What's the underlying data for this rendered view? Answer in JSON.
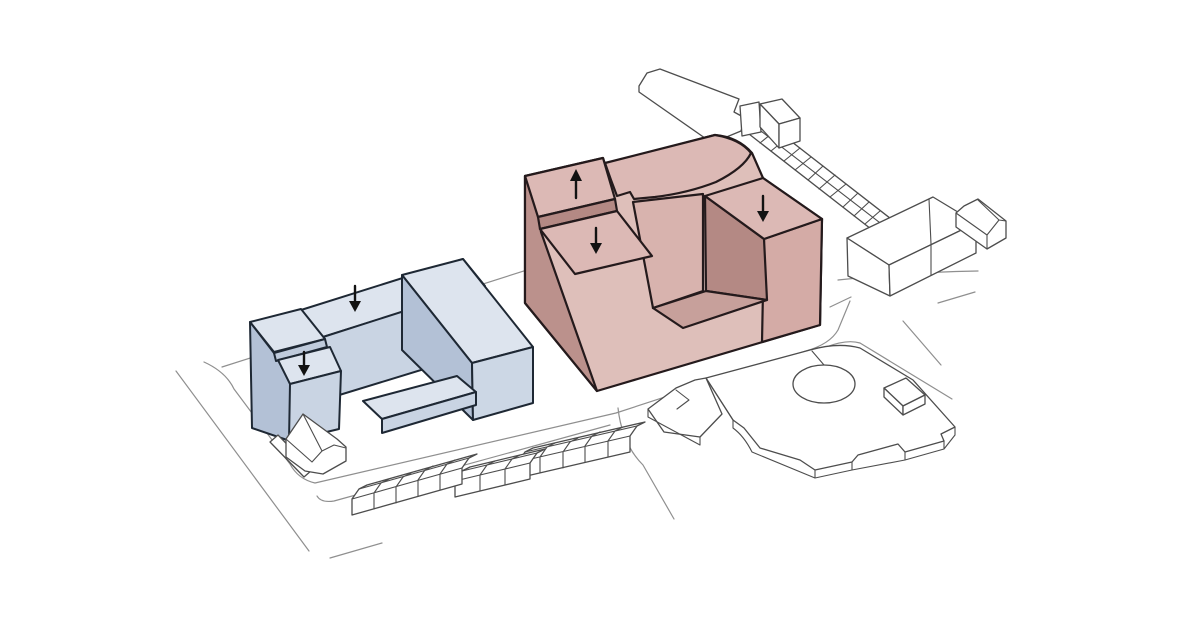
{
  "diagram": {
    "type": "axonometric urban site-plan massing diagram",
    "background": "#ffffff"
  },
  "palette": {
    "paper": "#ffffff",
    "road": "#8f8f8f",
    "context_ink": "#4d4d4d",
    "white_fill": "#ffffff",
    "red_top": "#dcb9b5",
    "red_front": "#debfba",
    "red_side": "#bb918c",
    "red_court_light": "#d8b3ae",
    "red_court_dark": "#b48984",
    "red_floor": "#c7a09b",
    "red_end": "#d4aba6",
    "red_ink": "#241a1c",
    "blue_top": "#dde4ee",
    "blue_front": "#c9d4e3",
    "blue_light": "#ccd7e5",
    "blue_dark": "#b3c1d6",
    "blue_mid": "#bfcbdc",
    "blue_ink": "#1e2834",
    "arrow": "#121212"
  },
  "arrows": [
    {
      "id": "red-tower",
      "building": "red-highlighted-building",
      "direction": "up",
      "symbol": "↑"
    },
    {
      "id": "red-left-block",
      "building": "red-highlighted-building",
      "direction": "down",
      "symbol": "↓"
    },
    {
      "id": "red-right-wing",
      "building": "red-highlighted-building",
      "direction": "down",
      "symbol": "↓"
    },
    {
      "id": "blue-back-bar",
      "building": "blue-courtyard-building",
      "direction": "down",
      "symbol": "↓"
    },
    {
      "id": "blue-front-tower",
      "building": "blue-courtyard-building",
      "direction": "down",
      "symbol": "↓"
    }
  ]
}
